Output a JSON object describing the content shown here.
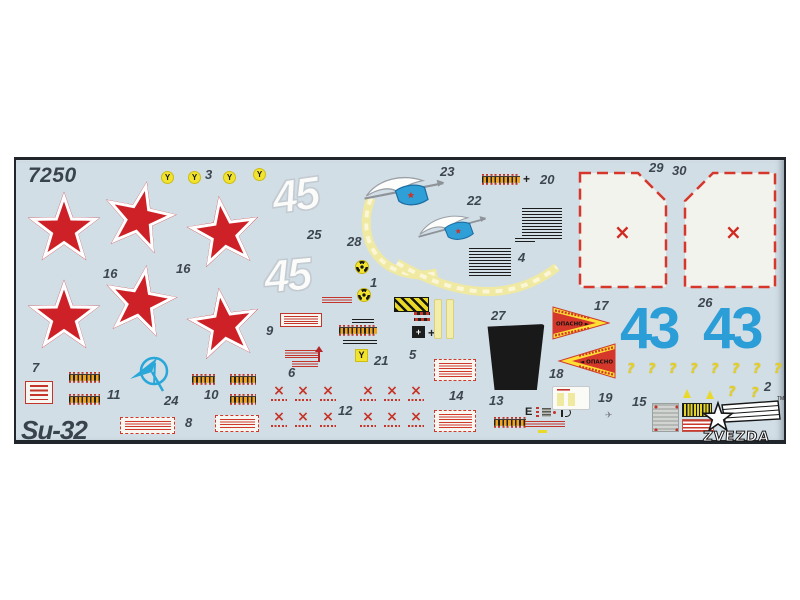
{
  "sheet": {
    "kit_number": "7250",
    "aircraft_name": "Su-32"
  },
  "brand": {
    "name": "ZVEZDA",
    "trademark": "TM"
  },
  "decals": {
    "bort_number_white": "45",
    "bort_number_blue": "43",
    "cross_glyph": "×",
    "question_glyph": "?",
    "hazard_letter": "Y",
    "plus_glyph": "+",
    "stencil_letter": "E",
    "plane_glyph": "✈",
    "pennant_text_right": "ОПАСНО ►",
    "pennant_text_left": "◄ ОПАСНО"
  },
  "labels": {
    "n1": "1",
    "n2": "2",
    "n3": "3",
    "n4": "4",
    "n5": "5",
    "n6": "6",
    "n7": "7",
    "n8": "8",
    "n9": "9",
    "n10": "10",
    "n11": "11",
    "n12": "12",
    "n13": "13",
    "n14": "14",
    "n15": "15",
    "n16": "16",
    "n17": "17",
    "n18": "18",
    "n19": "19",
    "n20": "20",
    "n21": "21",
    "n22": "22",
    "n23": "23",
    "n24": "24",
    "n25": "25",
    "n26": "26",
    "n27": "27",
    "n28": "28",
    "n29": "29",
    "n30": "30"
  },
  "colors": {
    "sheet_background": "#d2dee6",
    "star_red": "#cd2127",
    "blue_number": "#2c9ed7",
    "pale_yellow_walkway": "#efe9a2",
    "bright_yellow": "#f2e32f",
    "orange_stripe": "#f0a321",
    "stencil_red": "#cf382b",
    "callout_text": "#3c4650"
  }
}
